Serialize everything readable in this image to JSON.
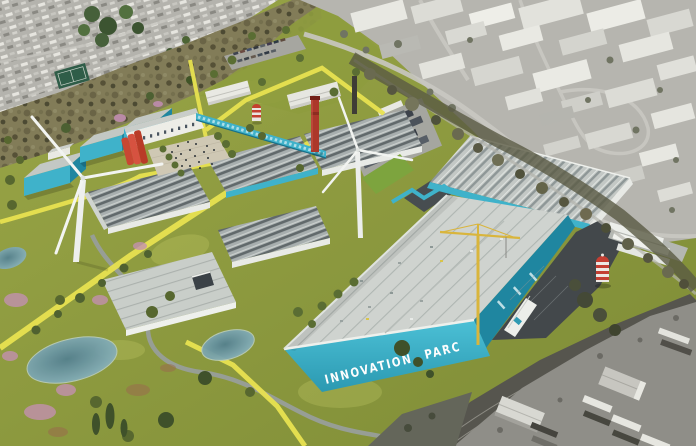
{
  "scene": {
    "signage": {
      "building_wall_text": "INNOVATION PARC"
    },
    "palette": {
      "teal_wall": "#3fb2ca",
      "teal_dark": "#1f86a0",
      "roof_light": "#ced3cf",
      "grass": "#8a9638",
      "grass_light": "#a4ae4b",
      "path_yellow": "#e8e250",
      "path_gray": "#979e95",
      "pond": "#7fa9b4",
      "urban_gray": "#b6b5af",
      "asphalt": "#43484b",
      "red_building": "#cc4835",
      "chimney_red": "#ac382a",
      "crane_yellow": "#d9b53c",
      "shrub_pink": "#c391af",
      "scrub": "#827c58",
      "tree_green": "#57672f",
      "signage_white": "#fdfdfd"
    },
    "features": [
      "residential-neighborhood",
      "hillside-scrub",
      "industrial-estate-north",
      "tree-belt",
      "footpaths",
      "ponds",
      "meadow-planting",
      "studio-buildings",
      "factory-building",
      "arts-building",
      "event-plaza",
      "linear-gallery-building",
      "central-warehouses",
      "companion-warehouse",
      "innovation-parc-building",
      "service-yard",
      "tower-crane",
      "water-tower",
      "shipping-containers",
      "gatehouse",
      "railway-corridor",
      "industrial-yard-south",
      "chimney",
      "park-water-tower",
      "wind-turbine-west",
      "wind-turbine-center",
      "car-park",
      "trailer-park",
      "sports-court"
    ]
  }
}
